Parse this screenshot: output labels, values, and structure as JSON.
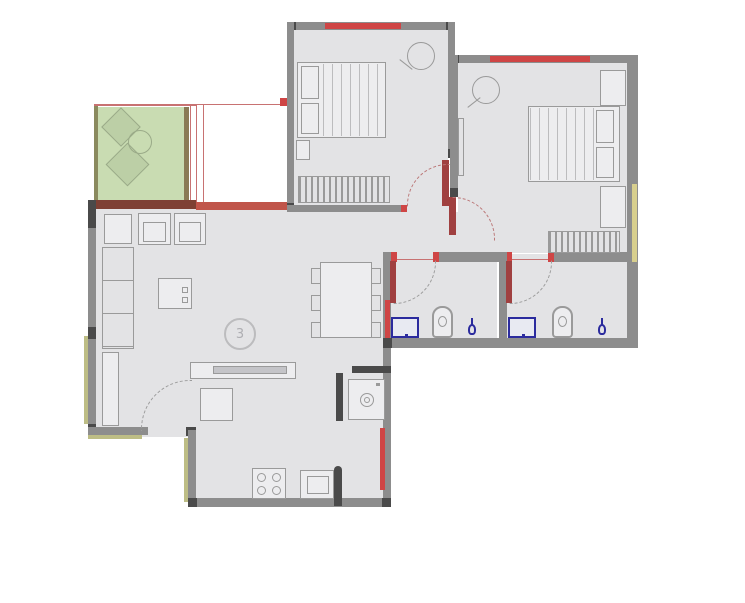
{
  "colors": {
    "bg": "#ffffff",
    "floor": "#e3e3e5",
    "floor_light": "#ededef",
    "wall": "#8d8d8d",
    "wall_dark": "#4a4a4a",
    "wall_brown": "#7e4034",
    "terrace_red": "#c0554a",
    "window_red": "#cf4545",
    "door_red": "#a04040",
    "thin_red": "#c87272",
    "window_yellow": "#d8cf8e",
    "khaki": "#bdbd85",
    "balcony_green": "#c9dcb2",
    "balcony_border": "#8a8a5e",
    "decor_line": "#9aaa88",
    "line": "#9a9a9a",
    "line_soft": "#bcbcbe",
    "blue": "#2b2b9e",
    "arc_gray": "#9c9c9c",
    "arc_red": "#bb7777"
  },
  "living": {
    "fan_label": "3"
  },
  "legend": {
    "fixtures": [
      "bed",
      "pillow",
      "wardrobe",
      "ceiling-fan",
      "sofa",
      "armchair",
      "center-table",
      "dining-table",
      "chair",
      "tv-unit",
      "shoe-rack",
      "hob",
      "kitchen-sink",
      "washing-machine",
      "wc",
      "washbasin",
      "tap",
      "balcony-planter",
      "door-swing",
      "window"
    ]
  }
}
